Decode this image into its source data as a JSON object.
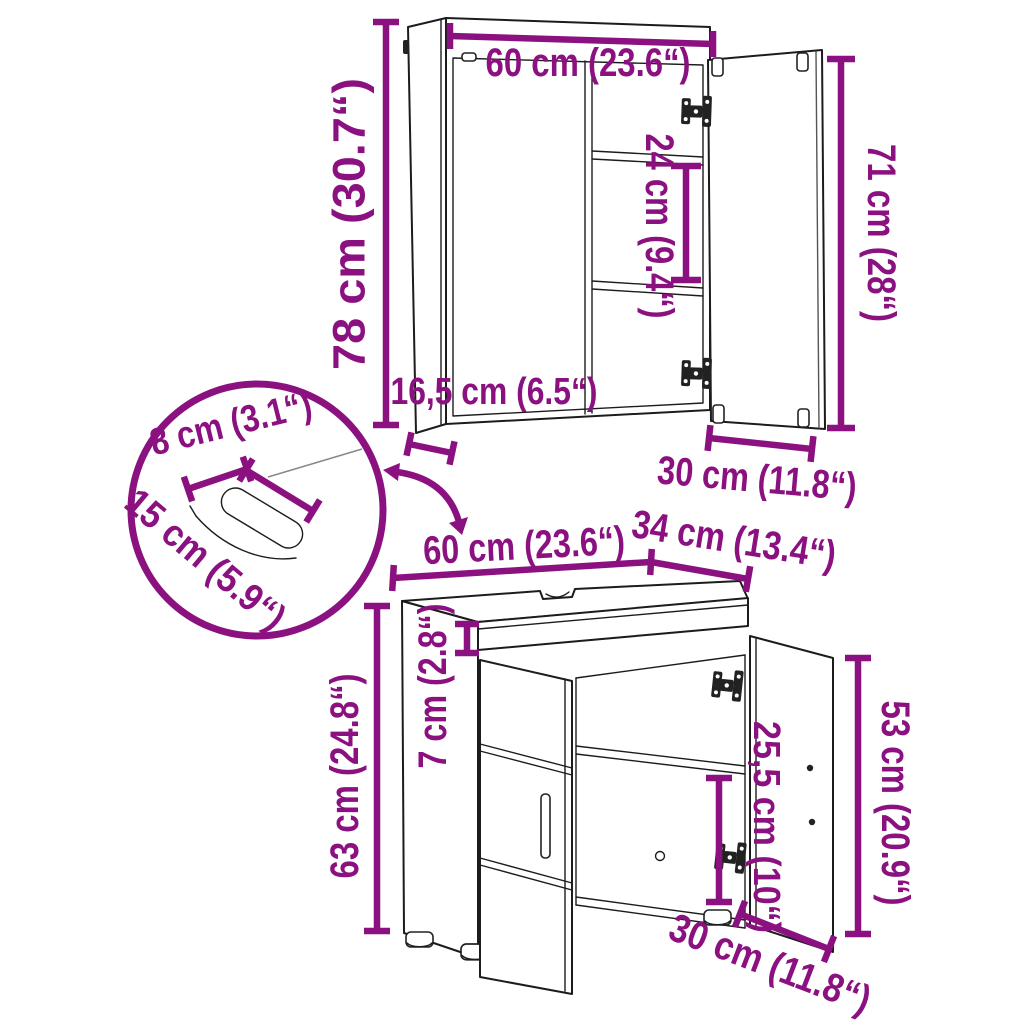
{
  "diagram": {
    "background": "#ffffff",
    "accent_color": "#8B1180",
    "line_color": "#1c1c1c",
    "mirror_cabinet": {
      "width_label": "60 cm (23.6“)",
      "shelf_spacing_label": "24 cm (9.4“)",
      "door_height_label": "71 cm (28“)",
      "height_label": "78 cm (30.7“)",
      "depth_label": "16,5 cm (6.5“)",
      "door_width_label": "30 cm (11.8“)"
    },
    "cutout_detail": {
      "width_label": "8 cm (3.1“)",
      "length_label": "15 cm (5.9“)"
    },
    "sink_cabinet": {
      "width_label": "60 cm (23.6“)",
      "depth_label": "34 cm (13.4“)",
      "apron_label": "7 cm (2.8“)",
      "height_label": "63 cm (24.8“)",
      "door_height_label": "53 cm (20.9“)",
      "interior_label": "25,5 cm (10“)",
      "door_width_label": "30 cm (11.8“)"
    }
  }
}
